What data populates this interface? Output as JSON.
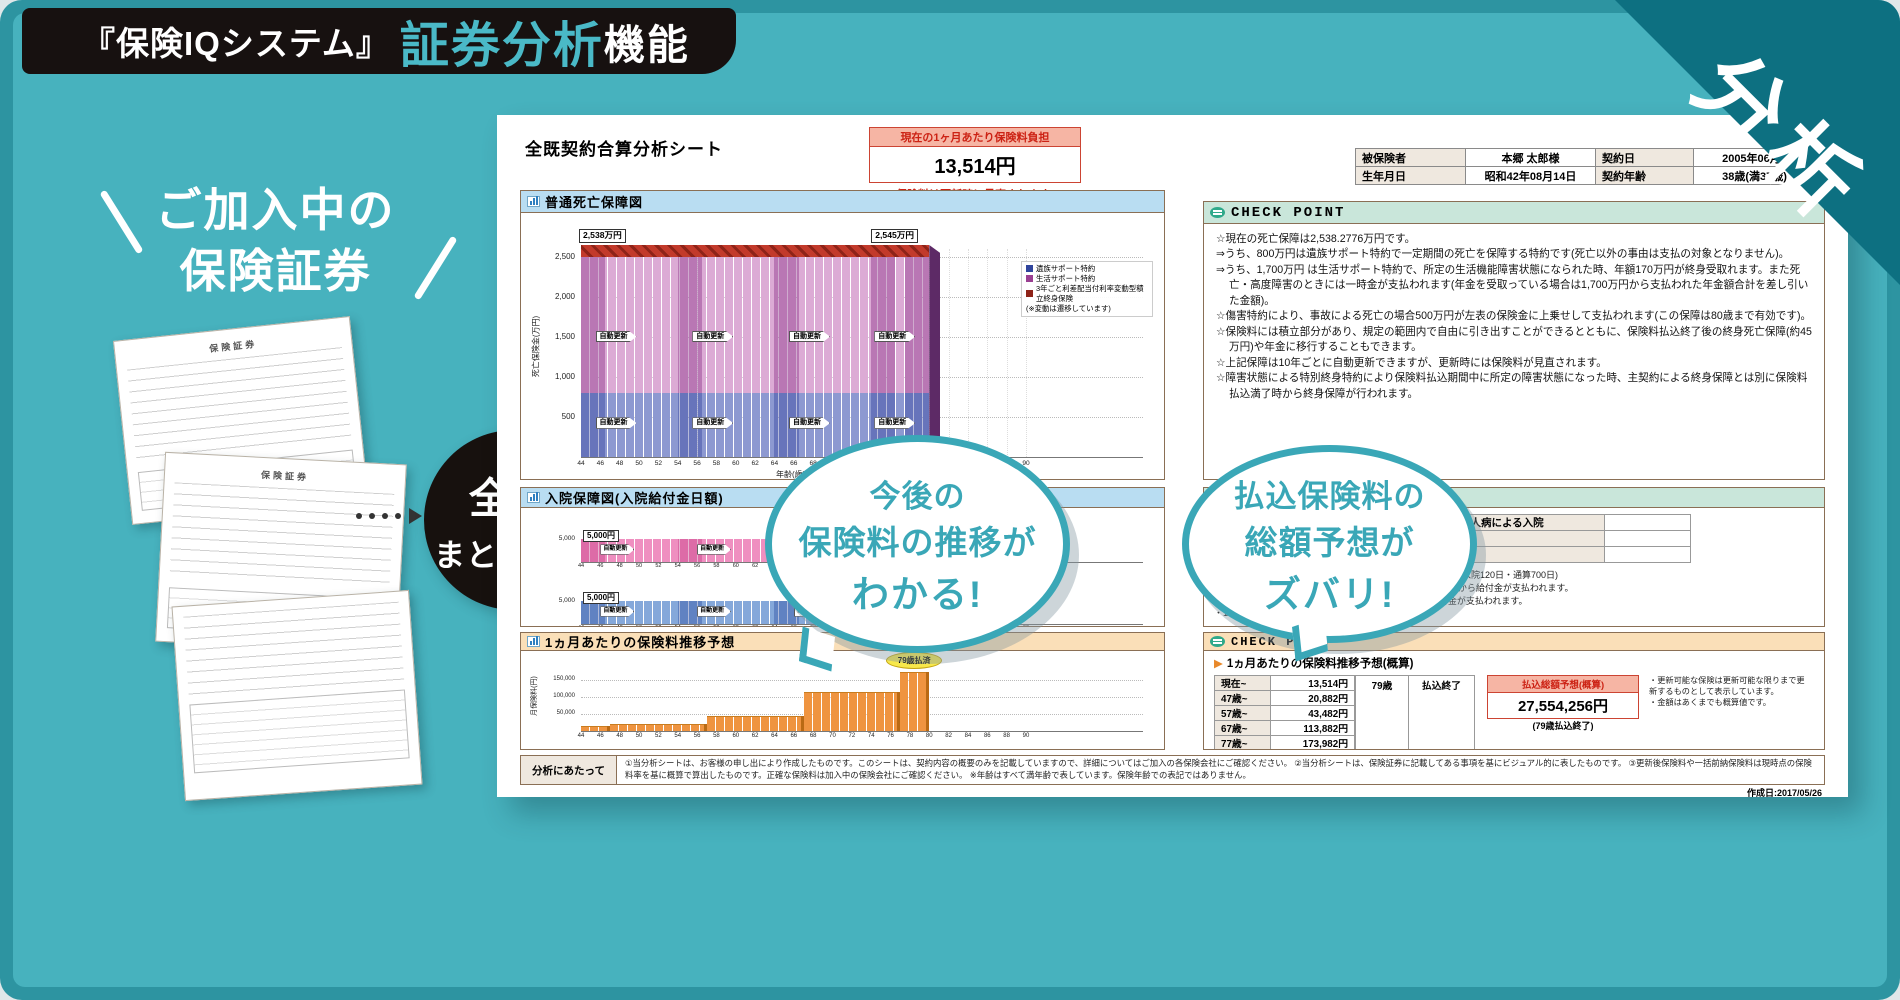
{
  "palette": {
    "bg": "#47b2be",
    "frame": "#2d94a1",
    "corner": "#0d7081",
    "banner_bg": "#171110",
    "accent": "#4ab9c7",
    "bubble": "#3aa7b7",
    "red": "#cc2214",
    "red_bg": "#f6b5a4",
    "mint": "#c9e6da",
    "orange": "#fadfb8",
    "blue_hdr": "#b9ddf2"
  },
  "banner": {
    "bracket_text": "『保険IQシステム』",
    "highlight": "証券分析",
    "suffix": "機能"
  },
  "corner_badge": "分析",
  "headline": {
    "line1": "ご加入中の",
    "line2": "保険証券"
  },
  "papers": {
    "label": "保険証券"
  },
  "merge_circle": {
    "line1": "全部",
    "line2": "まとめると"
  },
  "bubbles": {
    "b1": {
      "line1": "今後の",
      "line2": "保険料の推移が",
      "line3": "わかる!"
    },
    "b2": {
      "line1": "払込保険料の",
      "line2": "総額予想が",
      "line3": "ズバリ!"
    }
  },
  "sheet": {
    "title": "全既契約合算分析シート",
    "premium_box": {
      "header": "現在の1ヶ月あたり保険料負担",
      "value": "13,514円",
      "note": "保険料は更新時に見直されます!"
    },
    "insured": {
      "r1": [
        "被保険者",
        "本郷 太郎様",
        "契約日",
        "2005年06月0"
      ],
      "r2": [
        "生年月日",
        "昭和42年08月14日",
        "契約年齢",
        "38歳(満37歳)"
      ]
    },
    "sec1": {
      "checkpoint": "CHECK POINT",
      "lines": [
        "☆現在の死亡保障は2,538.2776万円です。",
        "⇒うち、800万円は遺族サポート特約で一定期間の死亡を保障する特約です(死亡以外の事由は支払の対象となりません)。",
        "⇒うち、1,700万円 は生活サポート特約で、所定の生活機能障害状態になられた時、年額170万円が終身受取れます。また死亡・高度障害のときには一時金が支払われます(年金を受取っている場合は1,700万円から支払われた年金額合計を差し引いた金額)。",
        "☆傷害特約により、事故による死亡の場合500万円が左表の保険金に上乗せして支払われます(この保障は80歳まで有効です)。",
        "☆保険料には積立部分があり、規定の範囲内で自由に引き出すことができるとともに、保険料払込終了後の終身死亡保障(約45万円)や年金に移行することもできます。",
        "☆上記保障は10年ごとに自動更新できますが、更新時には保険料が見直されます。",
        "☆障害状態による特別終身特約により保険料払込期間中に所定の障害状態になった時、主契約による終身保障とは別に保険料払込満了時から終身保障が行われます。"
      ]
    },
    "sec2": {
      "checkpoint": "CHECK POINT",
      "table": [
        [
          "病気による入院",
          "5,000円",
          "成人病による入院",
          ""
        ],
        [
          "ケガによる入院",
          "5,000円",
          "",
          ""
        ],
        [
          "特定の病気による入院",
          "",
          "",
          ""
        ]
      ],
      "notes": [
        "・入院給付金の支払:継続1日以上1日目からの給付(給付限度:1入院120日・通算700日)",
        "・医療特約により病気やケガで1日以上入院された時、1日目から給付金が支払われます。",
        "・手術特約により所定の日帰り手術、入院中の手術に給付金が支払われます。",
        "・10年ごとに最長80歳まで更新(自動更新)されます。"
      ]
    },
    "sec3": {
      "checkpoint": "CHECK POINT",
      "sub": "1ヵ月あたりの保険料推移予想(概算)",
      "rows": [
        [
          "現在~",
          "13,514円"
        ],
        [
          "47歳~",
          "20,882円"
        ],
        [
          "57歳~",
          "43,482円"
        ],
        [
          "67歳~",
          "113,882円"
        ],
        [
          "77歳~",
          "173,982円"
        ]
      ],
      "end_age": "79歳",
      "end_label": "払込終了",
      "total": {
        "header": "払込総額予想(概算)",
        "value": "27,554,256円",
        "sub": "(79歳払込終了)"
      },
      "notes": [
        "・更新可能な保険は更新可能な限りまで更新するものとして表示しています。",
        "・金額はあくまでも概算値です。"
      ],
      "bottom": "・保険料の払い込みは80歳までです。"
    },
    "footer": {
      "label": "分析にあたって",
      "text": "①当分析シートは、お客様の申し出により作成したものです。このシートは、契約内容の概要のみを記載していますので、詳細についてはご加入の各保険会社にご確認ください。 ②当分析シートは、保険証券に記載してある事項を基にビジュアル的に表したものです。 ③更新後保険料や一括前納保険料は現時点の保険料率を基に概算で算出したものです。正確な保険料は加入中の保険会社にご確認ください。 ※年齢はすべて満年齢で表しています。保険年齢での表記ではありません。"
    },
    "created": "作成日:2017/05/26"
  },
  "chart_data": [
    {
      "type": "bar",
      "title": "普通死亡保障図",
      "ylabel": "死亡保険金(万円)",
      "xlabel": "年齢(歳)",
      "x_range": [
        44,
        90
      ],
      "bar_end_age": 80,
      "ylim": [
        0,
        2600
      ],
      "yticks": [
        500,
        1000,
        1500,
        2000,
        2500
      ],
      "series": [
        {
          "name": "遺族サポート特約",
          "value": 800,
          "color": "#8d99d1",
          "dark": "#2f449c"
        },
        {
          "name": "生活サポート特約",
          "value": 1700,
          "color": "#dcabd5",
          "dark": "#9a3f92"
        },
        {
          "name": "3年ごと利差配当付利率変動型積立終身保険",
          "value": 38,
          "color": "#c23a2b",
          "dark": "#8e2318"
        }
      ],
      "legend_note": "(※変動は遷移しています)",
      "labels": {
        "start": "2,538万円",
        "end": "2,545万円"
      },
      "renewal_label": "自動更新",
      "total_start": 2538.2776,
      "total_end": 2545
    },
    {
      "type": "bar",
      "title": "入院保障図(入院給付金日額)",
      "xlabel": "年齢(歳)",
      "x_range": [
        44,
        90
      ],
      "bar_end_age": 80,
      "ylim": [
        0,
        6000
      ],
      "sub": [
        {
          "name": "病気による入院",
          "daily_label": "5,000円",
          "value": 5000,
          "ytick": "5,000",
          "color": "#ef8fc0",
          "dark": "#cf3f8f"
        },
        {
          "name": "ケガによる入院",
          "daily_label": "5,000円",
          "value": 5000,
          "ytick": "5,000",
          "color": "#85a8da",
          "dark": "#3a62ae"
        }
      ],
      "renewal_label": "自動更新"
    },
    {
      "type": "bar",
      "title": "1ヵ月あたりの保険料推移予想",
      "ylabel": "月保険料(円)",
      "xlabel": "年齢(歳)",
      "x_range": [
        44,
        90
      ],
      "ylim": [
        0,
        200000
      ],
      "yticks": [
        50000,
        100000,
        150000
      ],
      "steps": [
        [
          44,
          47,
          13514
        ],
        [
          47,
          57,
          20882
        ],
        [
          57,
          67,
          43482
        ],
        [
          67,
          77,
          113882
        ],
        [
          77,
          80,
          173982
        ]
      ],
      "color": "#ef9440",
      "dark": "#b96a14",
      "end_badge": "79歳払済"
    }
  ]
}
